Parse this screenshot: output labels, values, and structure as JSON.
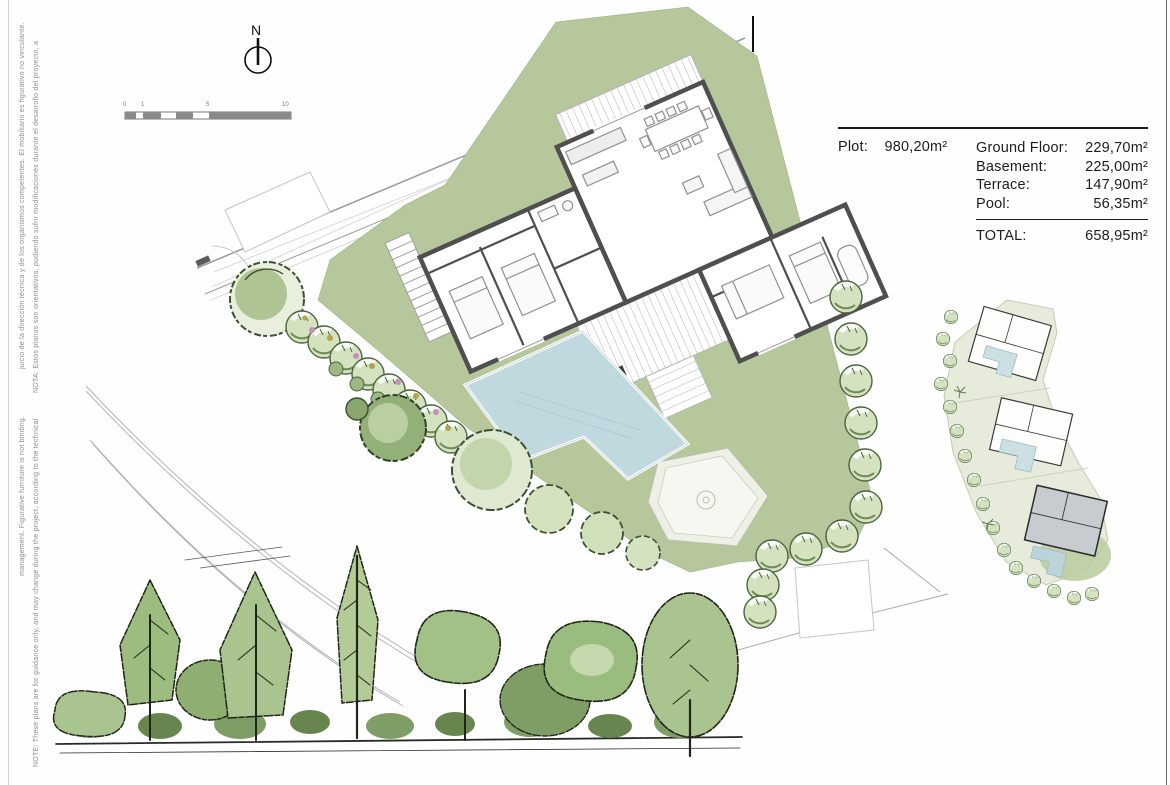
{
  "notes": {
    "spanish_line1": "NOTA: Estos planos son orientativos, pudiendo sufrir modificaciones durante el desarrollo del proyecto, a",
    "spanish_line2": "juicio de la dirección técnica y de los organismos competentes. El mobiliario es figurativo no vinculante.",
    "english_line1": "NOTE: These plans are for guidance only, and may change during the project, according to the technical",
    "english_line2": "management. Figurative furniture is not binding."
  },
  "compass": {
    "label": "N"
  },
  "scale_bar": {
    "labels": [
      "0",
      "1",
      "5",
      "10"
    ]
  },
  "area_table": {
    "plot_label": "Plot:",
    "plot_value": "980,20m²",
    "rows": [
      {
        "label": "Ground Floor:",
        "value": "229,70m²"
      },
      {
        "label": "Basement:",
        "value": "225,00m²"
      },
      {
        "label": "Terrace:",
        "value": "147,90m²"
      },
      {
        "label": "Pool:",
        "value": "56,35m²"
      }
    ],
    "total_label": "TOTAL:",
    "total_value": "658,95m²"
  },
  "colors": {
    "lawn_green": "#b6c79c",
    "pool_blue": "#bfd9de",
    "wall_dark": "#4f4f4f",
    "tree_fill": "#d4e2c0",
    "tree_stroke": "#4a653c",
    "sketch_green": "#a3c187",
    "inset_ground": "#e6ebdb",
    "highlight_villa_gray": "#c7ccd1",
    "flower_pink": "#c78fc0",
    "flower_yellow": "#b1a44b"
  }
}
